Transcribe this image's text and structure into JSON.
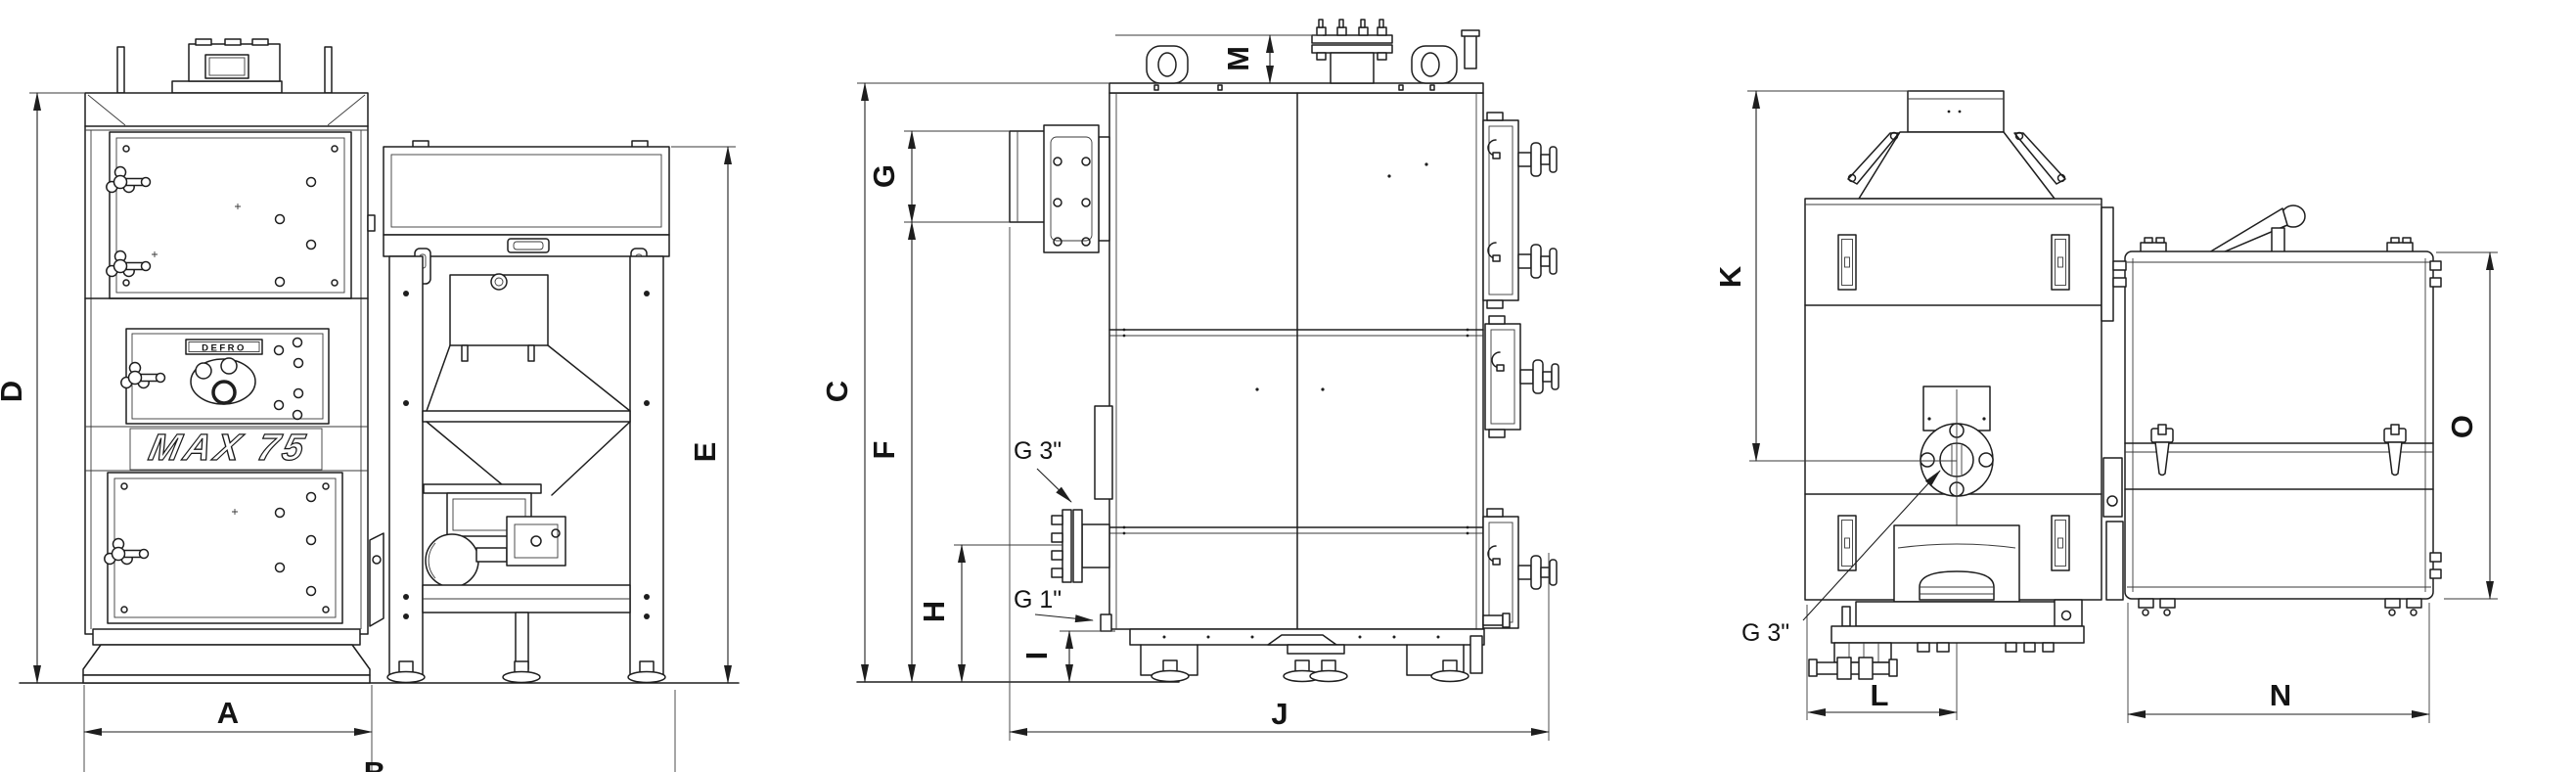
{
  "colors": {
    "line": "#1e1e1e",
    "background": "#ffffff"
  },
  "branding": {
    "brand": "DEFRO",
    "model": "MAX 75"
  },
  "dimensions": {
    "A": "A",
    "B": "B",
    "C": "C",
    "D": "D",
    "E": "E",
    "F": "F",
    "G": "G",
    "H": "H",
    "I": "I",
    "J": "J",
    "K": "K",
    "L": "L",
    "M": "M",
    "N": "N",
    "O": "O"
  },
  "connections": {
    "g3_side": "G 3\"",
    "g1_side": "G 1\"",
    "g3_rear": "G 3\""
  }
}
